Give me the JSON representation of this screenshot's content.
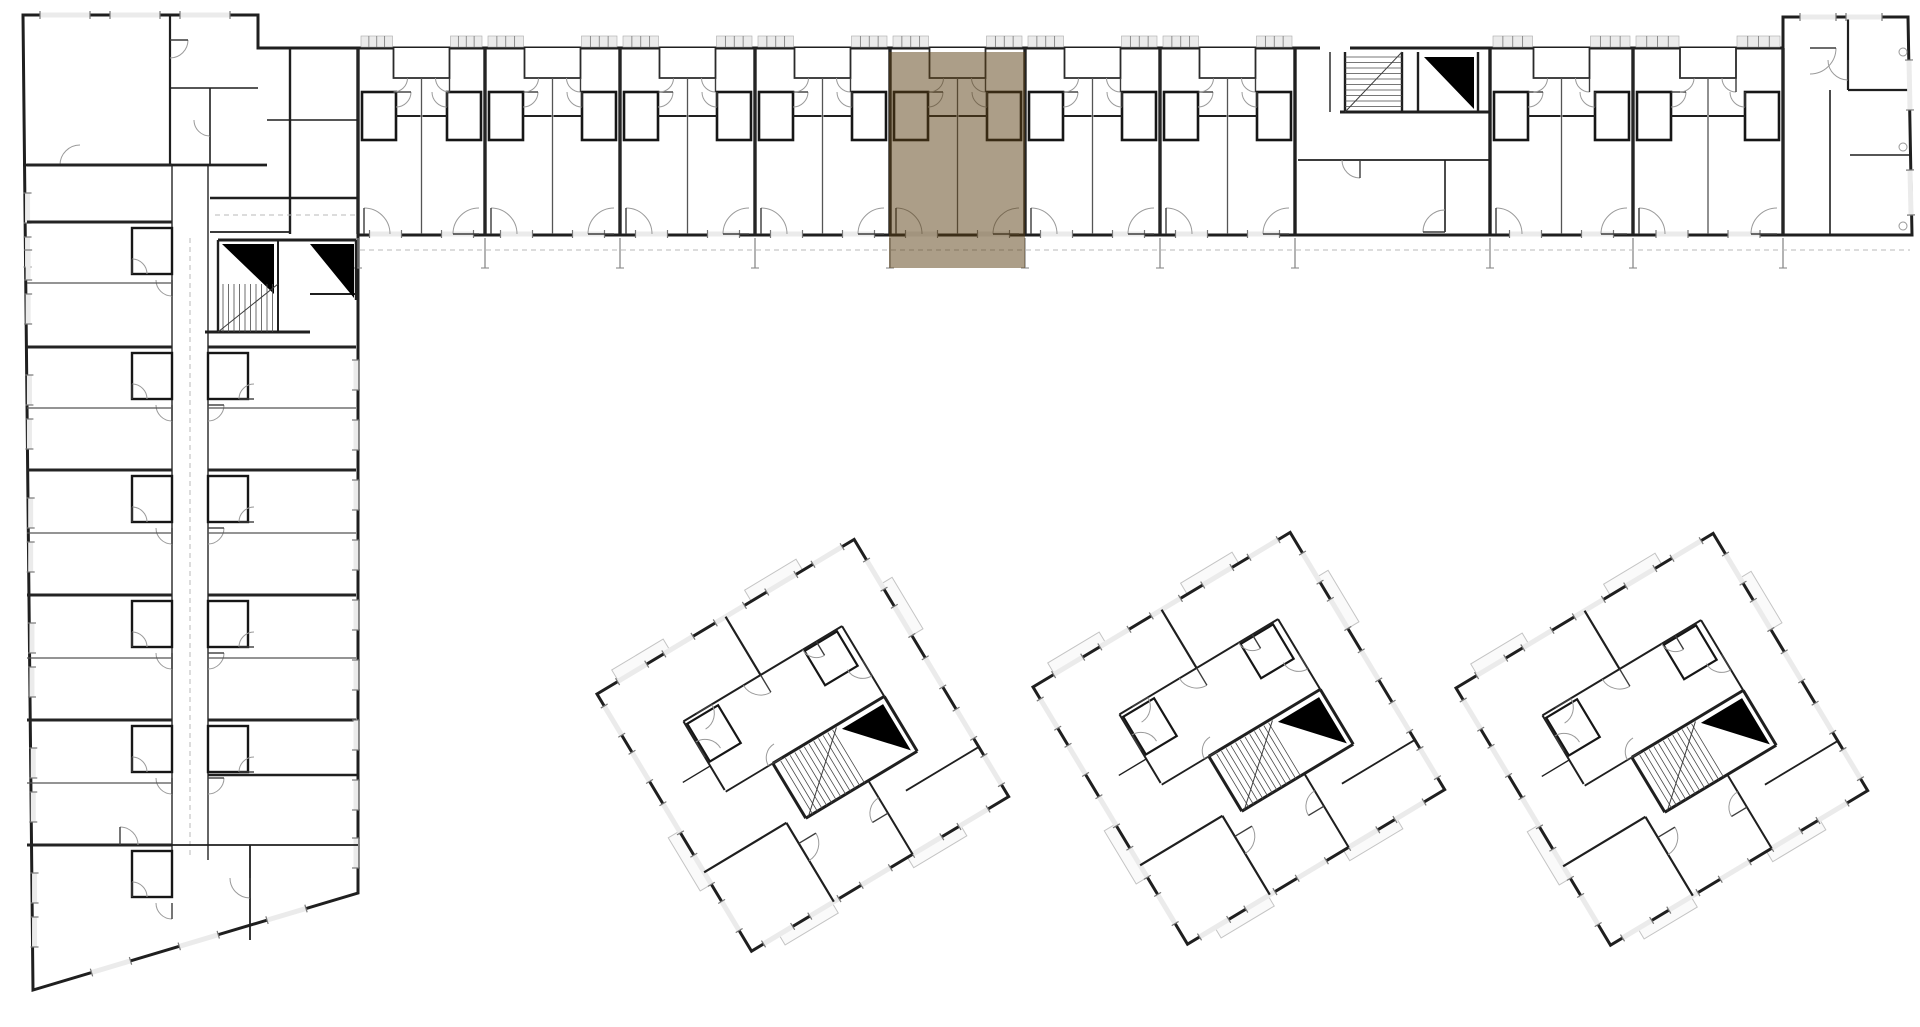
{
  "scene": {
    "canvas_w": 1920,
    "canvas_h": 1027,
    "background": "#ffffff"
  },
  "palette": {
    "wall_dark": "#1f1f1f",
    "wall_mid": "#3c3c3c",
    "wall_thin": "#555555",
    "window_fill": "#ebebeb",
    "window_tick": "#777777",
    "arc": "#9a9a9a",
    "dash": "#b8b8b8",
    "stub": "#8a8a8a",
    "balcony": "#c4c4c4",
    "elevator": "#000000",
    "tread": "#4a4a4a"
  },
  "highlight": {
    "name": "selected-unit",
    "x": 889,
    "y": 52,
    "width": 136,
    "height": 216,
    "color": "#5a3d11",
    "opacity": 0.5
  },
  "building_outline": [
    [
      23,
      15
    ],
    [
      258,
      15
    ],
    [
      258,
      48
    ],
    [
      1783,
      48
    ],
    [
      1783,
      17
    ],
    [
      1908,
      17
    ],
    [
      1912,
      235
    ],
    [
      358,
      235
    ],
    [
      358,
      893
    ],
    [
      33,
      990
    ]
  ],
  "long_wing": {
    "top_y": 48,
    "bottom_y": 234,
    "band_top": 36,
    "unit_runs": [
      {
        "boundaries": [
          358,
          485,
          620,
          755,
          890,
          1025,
          1160,
          1295
        ]
      },
      {
        "boundaries": [
          1490,
          1633,
          1783
        ]
      }
    ],
    "selected_unit": {
      "x1": 890,
      "x2": 1025
    },
    "core": {
      "x1": 1295,
      "x2": 1490,
      "stair": {
        "x": 1345,
        "y": 52,
        "w": 57,
        "h": 60
      },
      "elevator_wedge": {
        "x": 1424,
        "y": 57,
        "w": 50,
        "h": 52
      },
      "walls": [
        [
          1295,
          48,
          1295,
          234,
          3
        ],
        [
          1490,
          48,
          1490,
          234,
          3
        ],
        [
          1345,
          52,
          1345,
          112,
          2.4
        ],
        [
          1402,
          52,
          1402,
          112,
          2.4
        ],
        [
          1418,
          52,
          1418,
          112,
          2.4
        ],
        [
          1478,
          52,
          1478,
          112,
          2.4
        ],
        [
          1340,
          112,
          1490,
          112,
          3
        ],
        [
          1298,
          160,
          1490,
          160,
          1.8
        ],
        [
          1445,
          160,
          1445,
          232,
          1.6
        ],
        [
          1330,
          52,
          1330,
          112,
          1.4
        ]
      ]
    },
    "end_unit": {
      "walls": [
        [
          1848,
          17,
          1848,
          90,
          2.2
        ],
        [
          1848,
          90,
          1910,
          90,
          2.2
        ],
        [
          1850,
          155,
          1910,
          155,
          1.6
        ],
        [
          1830,
          90,
          1830,
          234,
          1.6
        ]
      ],
      "column_dots": [
        [
          1903,
          52
        ],
        [
          1903,
          147
        ],
        [
          1903,
          226
        ]
      ],
      "top_windows": [
        [
          1800,
          17,
          1836,
          17
        ],
        [
          1846,
          17,
          1882,
          17
        ]
      ],
      "side_windows": [
        [
          1909,
          60,
          1910,
          110
        ],
        [
          1910,
          170,
          1911,
          215
        ]
      ]
    },
    "junction_walls": [
      [
        290,
        48,
        290,
        234,
        2.4
      ],
      [
        267,
        120,
        358,
        120,
        1.6
      ],
      [
        210,
        198,
        358,
        198,
        2.4
      ],
      [
        210,
        232,
        290,
        232,
        1.8
      ]
    ],
    "gallery_dash_y": 250,
    "stub_bottom_y": 268
  },
  "left_wing": {
    "corridor_x1": 172,
    "corridor_x2": 208,
    "bays_west": [
      165,
      222,
      347,
      470,
      595,
      720,
      845
    ],
    "mid_west": [
      283,
      408,
      533,
      658,
      783
    ],
    "bays_east": [
      347,
      470,
      595,
      720
    ],
    "mid_east": [
      408,
      533,
      658
    ],
    "head_walls": [
      [
        170,
        15,
        170,
        165,
        2.2
      ],
      [
        170,
        88,
        258,
        88,
        1.6
      ],
      [
        210,
        88,
        210,
        165,
        1.6
      ],
      [
        23,
        165,
        267,
        165,
        2.8
      ]
    ],
    "extra_walls": [
      [
        208,
        775,
        358,
        775,
        2.4
      ],
      [
        250,
        845,
        250,
        940,
        1.8
      ],
      [
        172,
        845,
        358,
        845,
        1.8
      ]
    ],
    "core": {
      "elevator_wedges": [
        [
          222,
          244,
          52,
          50
        ],
        [
          310,
          244,
          44,
          54
        ]
      ],
      "stair": {
        "x": 218,
        "y": 284,
        "w": 60,
        "h": 48
      },
      "walls": [
        [
          218,
          240,
          356,
          240,
          3
        ],
        [
          278,
          240,
          278,
          332,
          2
        ],
        [
          205,
          332,
          310,
          332,
          3
        ],
        [
          218,
          240,
          218,
          332,
          2.4
        ],
        [
          356,
          240,
          356,
          300,
          2.4
        ],
        [
          310,
          294,
          356,
          294,
          2
        ]
      ]
    },
    "east_window_ys": [
      360,
      420,
      480,
      540,
      600,
      660,
      720,
      780,
      838
    ],
    "diag_window_fracs": [
      0.18,
      0.45,
      0.72
    ],
    "corridor_dash": [
      190,
      238,
      190,
      858
    ],
    "junction_dash": [
      215,
      215,
      358,
      215
    ]
  },
  "towers": {
    "side": 300,
    "rotation": -31,
    "top_left_anchors": [
      [
        597,
        694
      ],
      [
        1033,
        687
      ],
      [
        1456,
        688
      ]
    ],
    "template": {
      "walls": [
        [
          150,
          0,
          150,
          68,
          2.2
        ],
        [
          60,
          68,
          245,
          68,
          2.0
        ],
        [
          60,
          68,
          60,
          148,
          2.0
        ],
        [
          245,
          68,
          245,
          150,
          2.0
        ],
        [
          0,
          208,
          96,
          208,
          2.2
        ],
        [
          96,
          208,
          96,
          300,
          2.2
        ],
        [
          188,
          215,
          188,
          300,
          2.0
        ],
        [
          215,
          242,
          300,
          242,
          1.8
        ],
        [
          60,
          150,
          115,
          150,
          1.8
        ],
        [
          28,
          120,
          60,
          120,
          1.4
        ]
      ],
      "core_walls": [
        [
          115,
          150,
          245,
          150,
          3
        ],
        [
          115,
          150,
          115,
          214,
          3
        ],
        [
          115,
          214,
          245,
          214,
          3
        ],
        [
          245,
          150,
          245,
          214,
          3
        ]
      ],
      "stair": {
        "x": 118,
        "y": 152,
        "w": 70,
        "h": 62
      },
      "elevator_wedge": {
        "x": 192,
        "y": 156,
        "w": 48,
        "h": 54
      },
      "pods": [
        [
          62,
          72,
          36,
          44
        ],
        [
          200,
          70,
          38,
          40
        ]
      ],
      "arcs": [
        [
          150,
          68,
          20,
          90,
          180
        ],
        [
          60,
          110,
          18,
          270,
          360
        ],
        [
          245,
          108,
          18,
          90,
          180
        ],
        [
          96,
          232,
          20,
          0,
          90
        ],
        [
          188,
          252,
          18,
          180,
          270
        ],
        [
          126,
          150,
          16,
          180,
          270
        ],
        [
          75,
          68,
          18,
          0,
          90
        ],
        [
          215,
          68,
          16,
          90,
          180
        ]
      ],
      "window_fracs": [
        0.08,
        0.26,
        0.46,
        0.66,
        0.84
      ],
      "window_len": 34,
      "balconies": [
        [
          25,
          -13,
          60,
          13
        ],
        [
          180,
          -13,
          60,
          13
        ],
        [
          -13,
          160,
          13,
          62
        ],
        [
          32,
          300,
          62,
          12
        ],
        [
          182,
          300,
          62,
          12
        ],
        [
          300,
          52,
          13,
          60
        ]
      ]
    }
  },
  "head_top_windows": [
    [
      40,
      15,
      90,
      15
    ],
    [
      110,
      15,
      160,
      15
    ],
    [
      180,
      15,
      230,
      15
    ]
  ]
}
